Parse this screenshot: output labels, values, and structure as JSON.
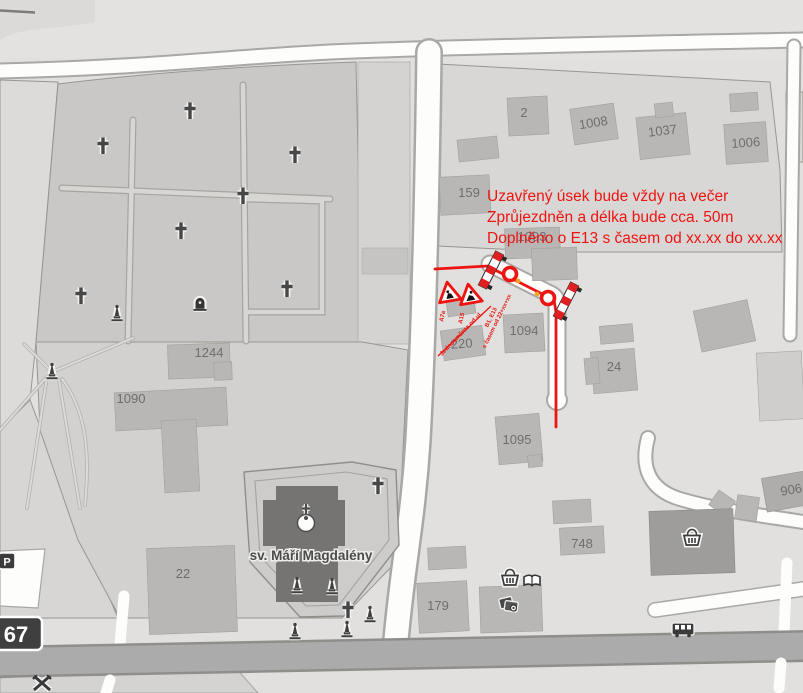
{
  "annotation": {
    "line1": "Uzavřený úsek bude vždy na večer",
    "line2": "Zprůjezdněn a délka bude cca. 50m",
    "line3": "Doplněno o E13 s časem od xx.xx do xx.xx"
  },
  "labels": {
    "church": "sv. Máří Magdalény",
    "road_badge": "67",
    "parking": "P"
  },
  "buildings": {
    "b2": "2",
    "b1008": "1008",
    "b1037": "1037",
    "b1006": "1006",
    "b159": "159",
    "b1093": "1093",
    "b1244": "1244",
    "b1090": "1090",
    "b22": "22",
    "b1094": "1094",
    "b220": "220",
    "b24": "24",
    "b1095": "1095",
    "b748": "748",
    "b179": "179",
    "b906": "906"
  },
  "closure": {
    "sign1_code": "A7a",
    "sign2_code": "A15",
    "note_line1": "B1, E13",
    "note_line2": "s časem od 22+xx+xx",
    "leader_note": "Jednosměrna od ul."
  },
  "colors": {
    "closure_red": "#ee1411",
    "marker_orange": "#f0a325",
    "building_label_gray": "#6e6e6e",
    "road_badge_bg": "#3f3f3f"
  }
}
